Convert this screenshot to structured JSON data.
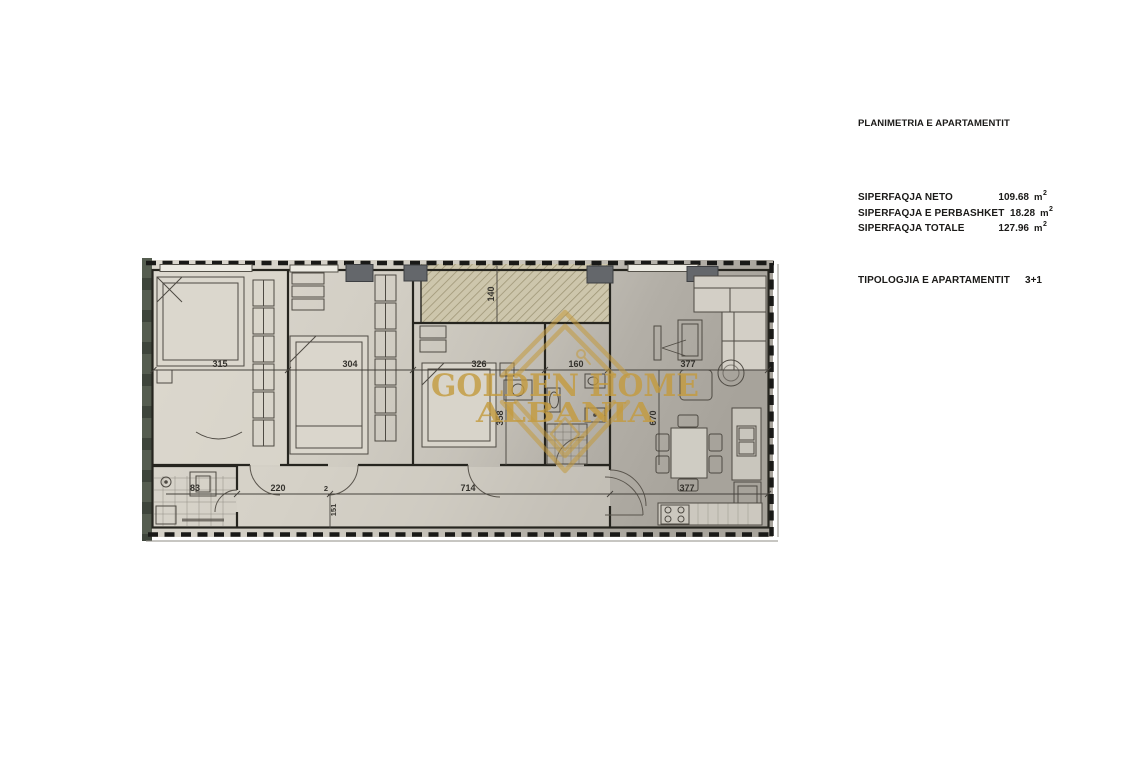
{
  "panel": {
    "title": "PLANIMETRIA E APARTAMENTIT",
    "area_rows": [
      {
        "label": "SIPERFAQJA NETO",
        "value": "109.68",
        "unit": "m",
        "unit_sup": "2"
      },
      {
        "label": "SIPERFAQJA E PERBASHKET",
        "value": "18.28",
        "unit": "m",
        "unit_sup": "2"
      },
      {
        "label": "SIPERFAQJA TOTALE",
        "value": "127.96",
        "unit": "m",
        "unit_sup": "2"
      }
    ],
    "typology": {
      "label": "TIPOLOGJIA E APARTAMENTIT",
      "value": "3+1"
    }
  },
  "watermark": {
    "line1": "GOLDEN HOME",
    "line2": "ALBANIA",
    "color": "#c49b3e"
  },
  "floorplan": {
    "dims": {
      "bedroom1_width": "315",
      "bedroom2_width": "304",
      "bedroom3_width": "326",
      "bathroom_width": "160",
      "living_width": "377",
      "bath2_width": "83",
      "hall_width": "220",
      "corridor_width": "714",
      "kitchen_width": "377",
      "balcony_depth": "140",
      "bedroom3_depth": "358",
      "living_depth": "670",
      "door_width": "151",
      "wall_tick": "2"
    },
    "colors": {
      "wall": "#26251f",
      "column": "#64676b",
      "left_wall": "#3e453b",
      "hatch_line": "#968d6c"
    }
  }
}
